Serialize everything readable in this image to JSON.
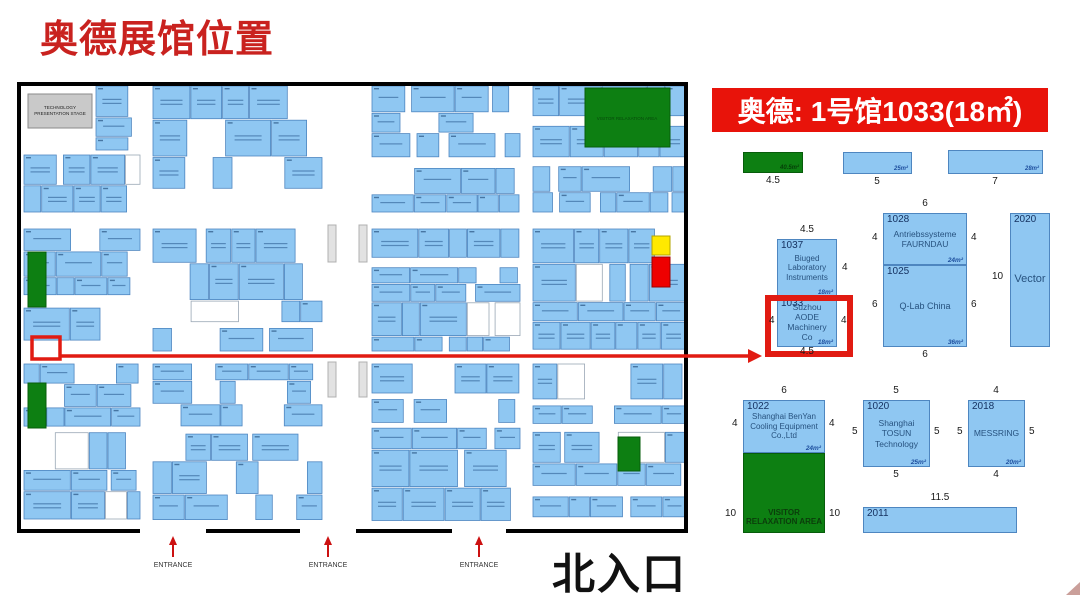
{
  "page_title": "奥德展馆位置",
  "banner_text": "奥德: 1号馆1033(18㎡)",
  "map": {
    "stage_label": "TECHNOLOGY PRESENTATION STAGE",
    "relax_label": "VISITOR RELAXATION AREA",
    "entrance_label": "ENTRANCE",
    "north_gate_label": "北入口"
  },
  "legend": {
    "green": {
      "area": "40.5m²",
      "width": "4.5"
    },
    "blue25": {
      "area": "25m²",
      "width": "5"
    },
    "blue28": {
      "area": "28m²",
      "width": "7"
    }
  },
  "booths": {
    "b1037": {
      "number": "1037",
      "name": "Biuged Laboratory Instruments",
      "area": "18m²",
      "dim_top": "4.5",
      "dim_right": "4"
    },
    "b1033": {
      "number": "1033",
      "name": "Suzhou AODE Machinery Co",
      "area": "18m²",
      "dim_left": "4",
      "dim_right": "4",
      "dim_bottom": "4.5"
    },
    "b1028": {
      "number": "1028",
      "name": "Antriebssysteme FAURNDAU",
      "area": "24m²",
      "dim_top": "6",
      "dim_left": "4",
      "dim_right": "4"
    },
    "b1025": {
      "number": "1025",
      "name": "Q-Lab China",
      "area": "36m²",
      "dim_left": "6",
      "dim_right": "6",
      "dim_bottom": "6"
    },
    "b2020": {
      "number": "2020",
      "name": "Vector",
      "dim_left": "10"
    },
    "b1022": {
      "number": "1022",
      "name": "Shanghai BenYan Cooling Equipment Co.,Ltd",
      "area": "24m²",
      "dim_top": "6",
      "dim_left": "4",
      "dim_right": "4"
    },
    "relax": {
      "name": "VISITOR RELAXATION AREA",
      "dim_left": "10",
      "dim_right": "10"
    },
    "b1020": {
      "number": "1020",
      "name": "Shanghai TOSUN Technology",
      "area": "25m²",
      "dim_top": "5",
      "dim_left": "5",
      "dim_right": "5",
      "dim_bottom": "5"
    },
    "b2018": {
      "number": "2018",
      "name": "MESSRING",
      "area": "20m²",
      "dim_top": "4",
      "dim_left": "5",
      "dim_right": "5",
      "dim_bottom": "4"
    },
    "b2011": {
      "number": "2011",
      "dim_top": "11.5"
    }
  },
  "colors": {
    "accent_red": "#e11b12",
    "title_red": "#c9221f",
    "booth_blue": "#8fc7f2",
    "booth_border": "#4e86c0",
    "green_area": "#0d7f12",
    "yellow_booth": "#ffe900",
    "red_booth": "#ee0000"
  }
}
